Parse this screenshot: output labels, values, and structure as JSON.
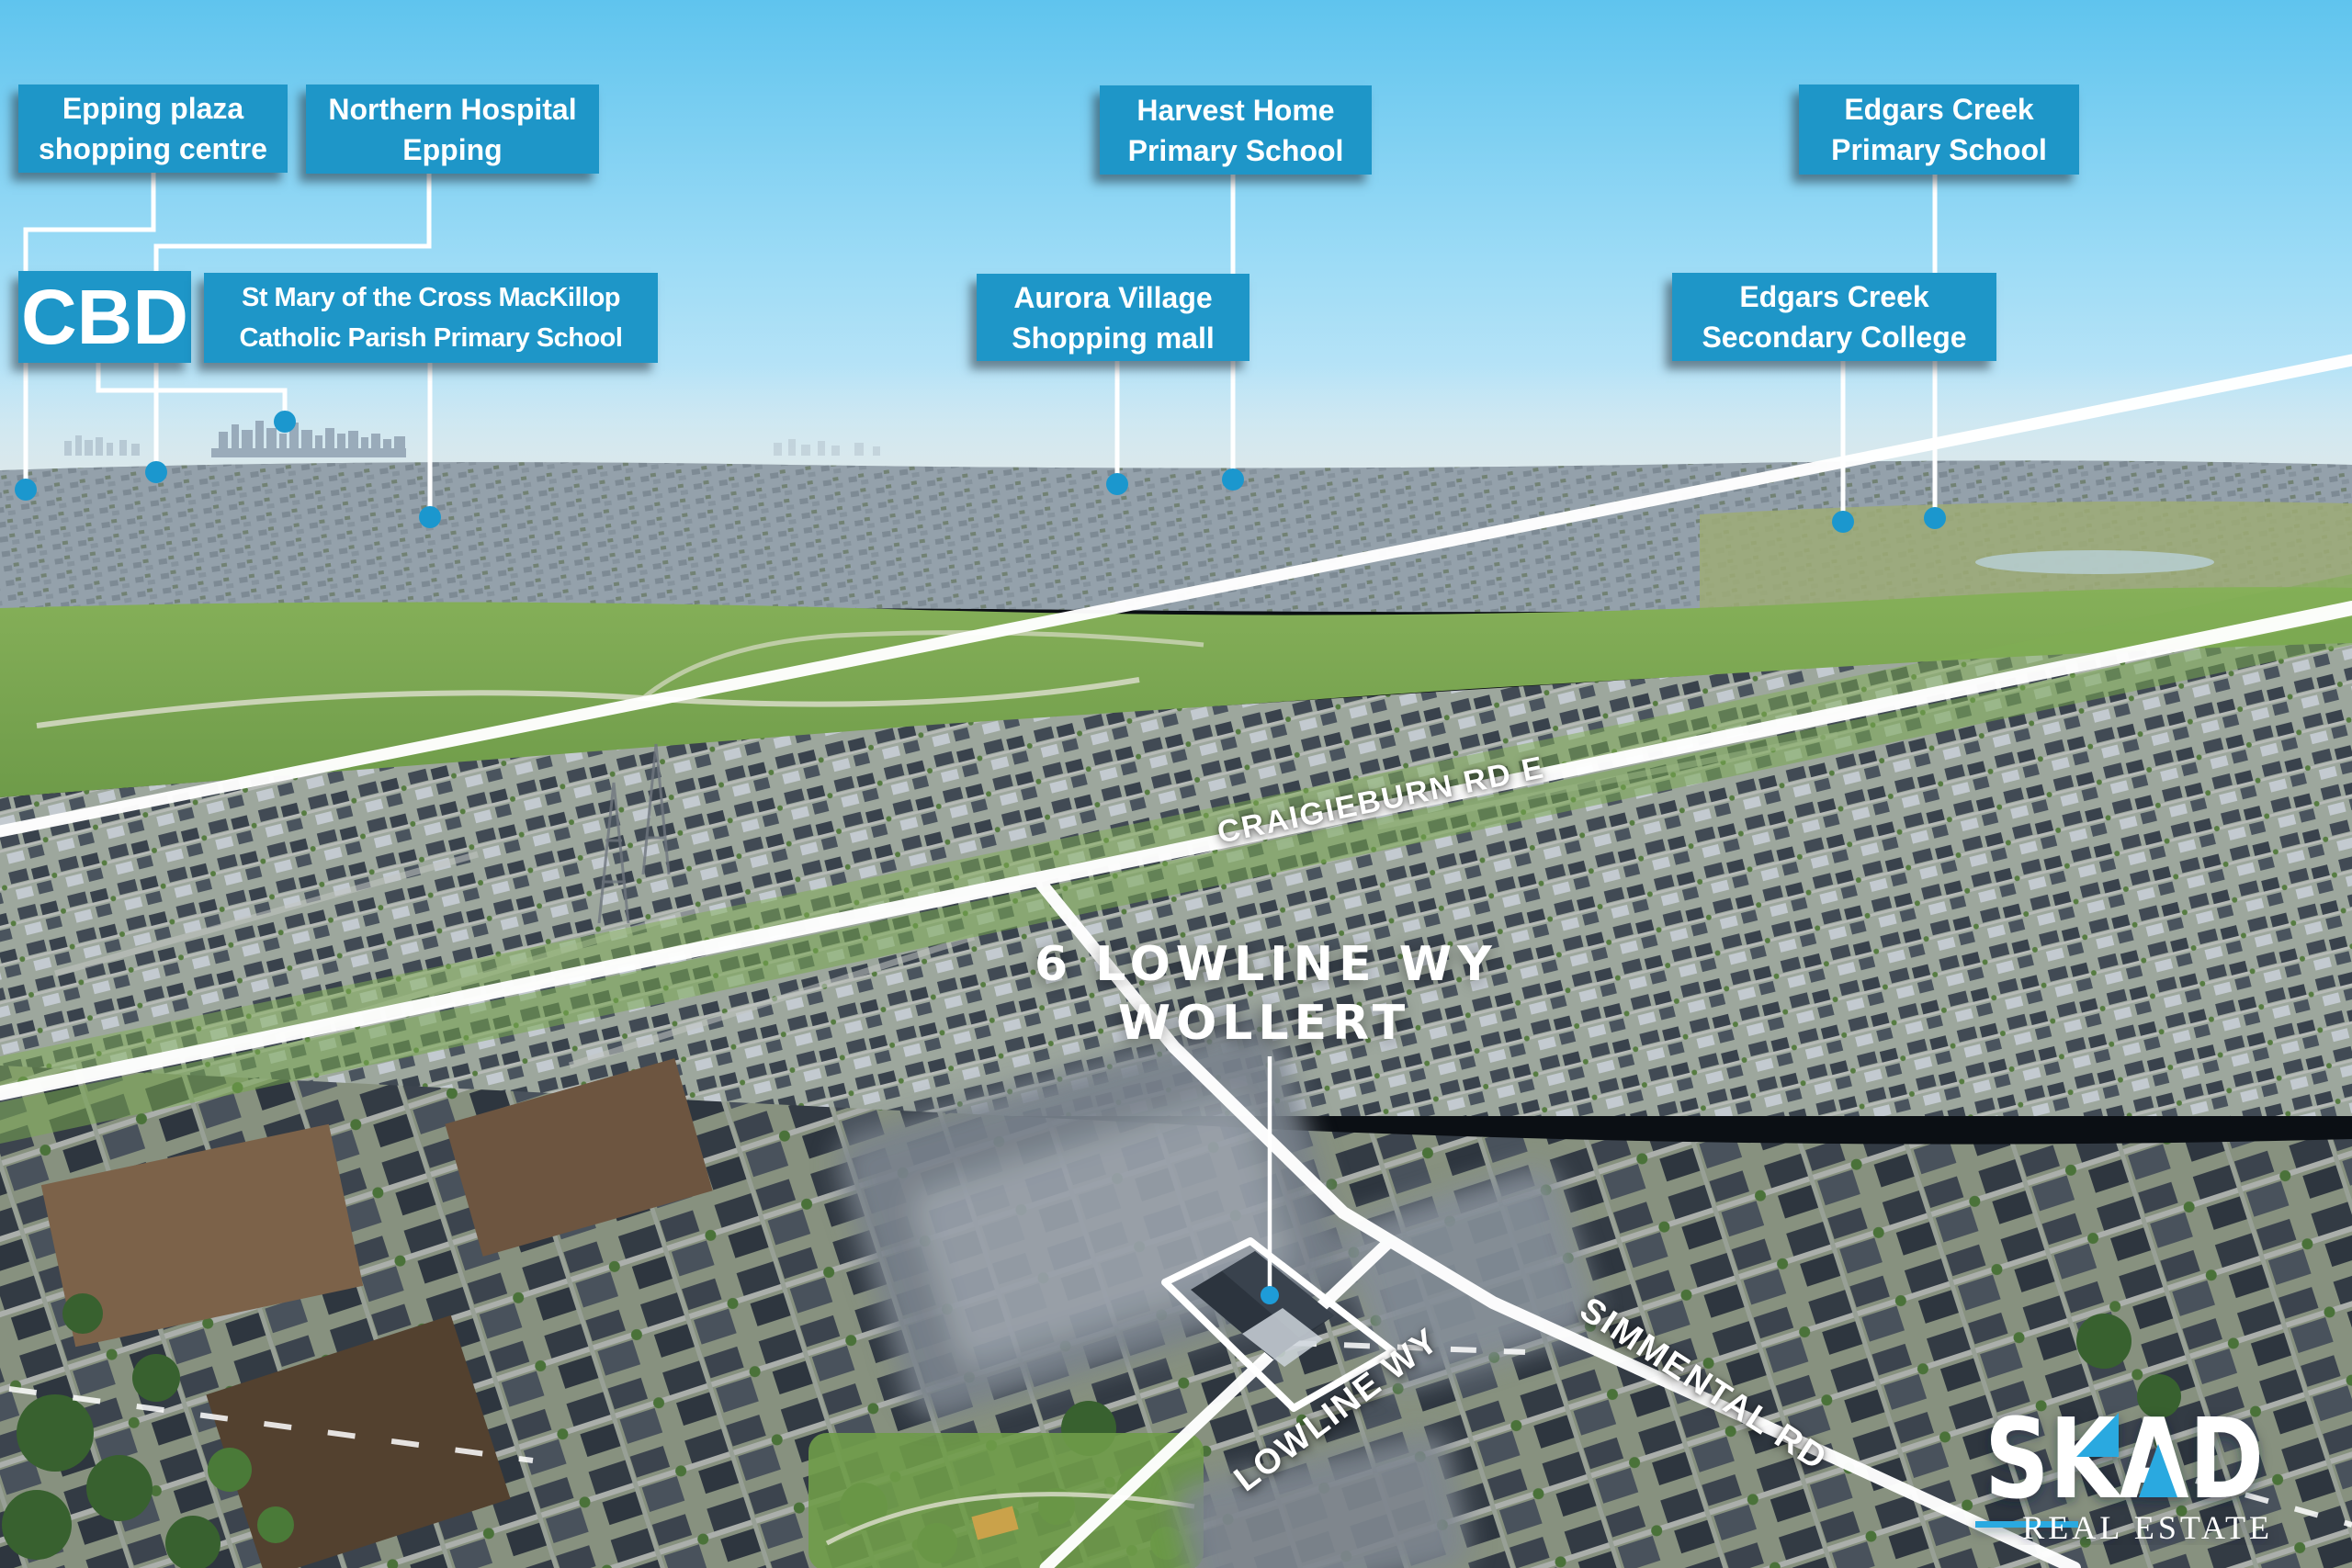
{
  "image_type": "real-estate aerial drone photo with location annotations",
  "property": {
    "title_line1": "6 LOWLINE WY",
    "title_line2": "WOLLERT"
  },
  "annotations": {
    "epping_plaza": {
      "line1": "Epping plaza",
      "line2": "shopping centre"
    },
    "northern_hospital": {
      "line1": "Northern Hospital",
      "line2": "Epping"
    },
    "cbd": {
      "line1": "CBD"
    },
    "st_mary": {
      "line1": "St Mary of the Cross MacKillop",
      "line2": "Catholic Parish Primary School"
    },
    "harvest_home": {
      "line1": "Harvest Home",
      "line2": "Primary School"
    },
    "aurora_village": {
      "line1": "Aurora Village",
      "line2": "Shopping mall"
    },
    "edgars_primary": {
      "line1": "Edgars Creek",
      "line2": "Primary School"
    },
    "edgars_secondary": {
      "line1": "Edgars Creek",
      "line2": "Secondary College"
    }
  },
  "roads": {
    "craigieburn": "CRAIGIEBURN RD E",
    "lowline": "LOWLINE WY",
    "simmental": "SIMMENTAL RD"
  },
  "logo": {
    "brand": "SKAD",
    "tagline": "REAL ESTATE"
  },
  "colors": {
    "label_background": "#1E96C8",
    "marker_dot": "#1B97CE",
    "logo_blue": "#2AA9E0",
    "leader_line": "#FFFFFF",
    "sky_top": "#5FC4EE"
  }
}
